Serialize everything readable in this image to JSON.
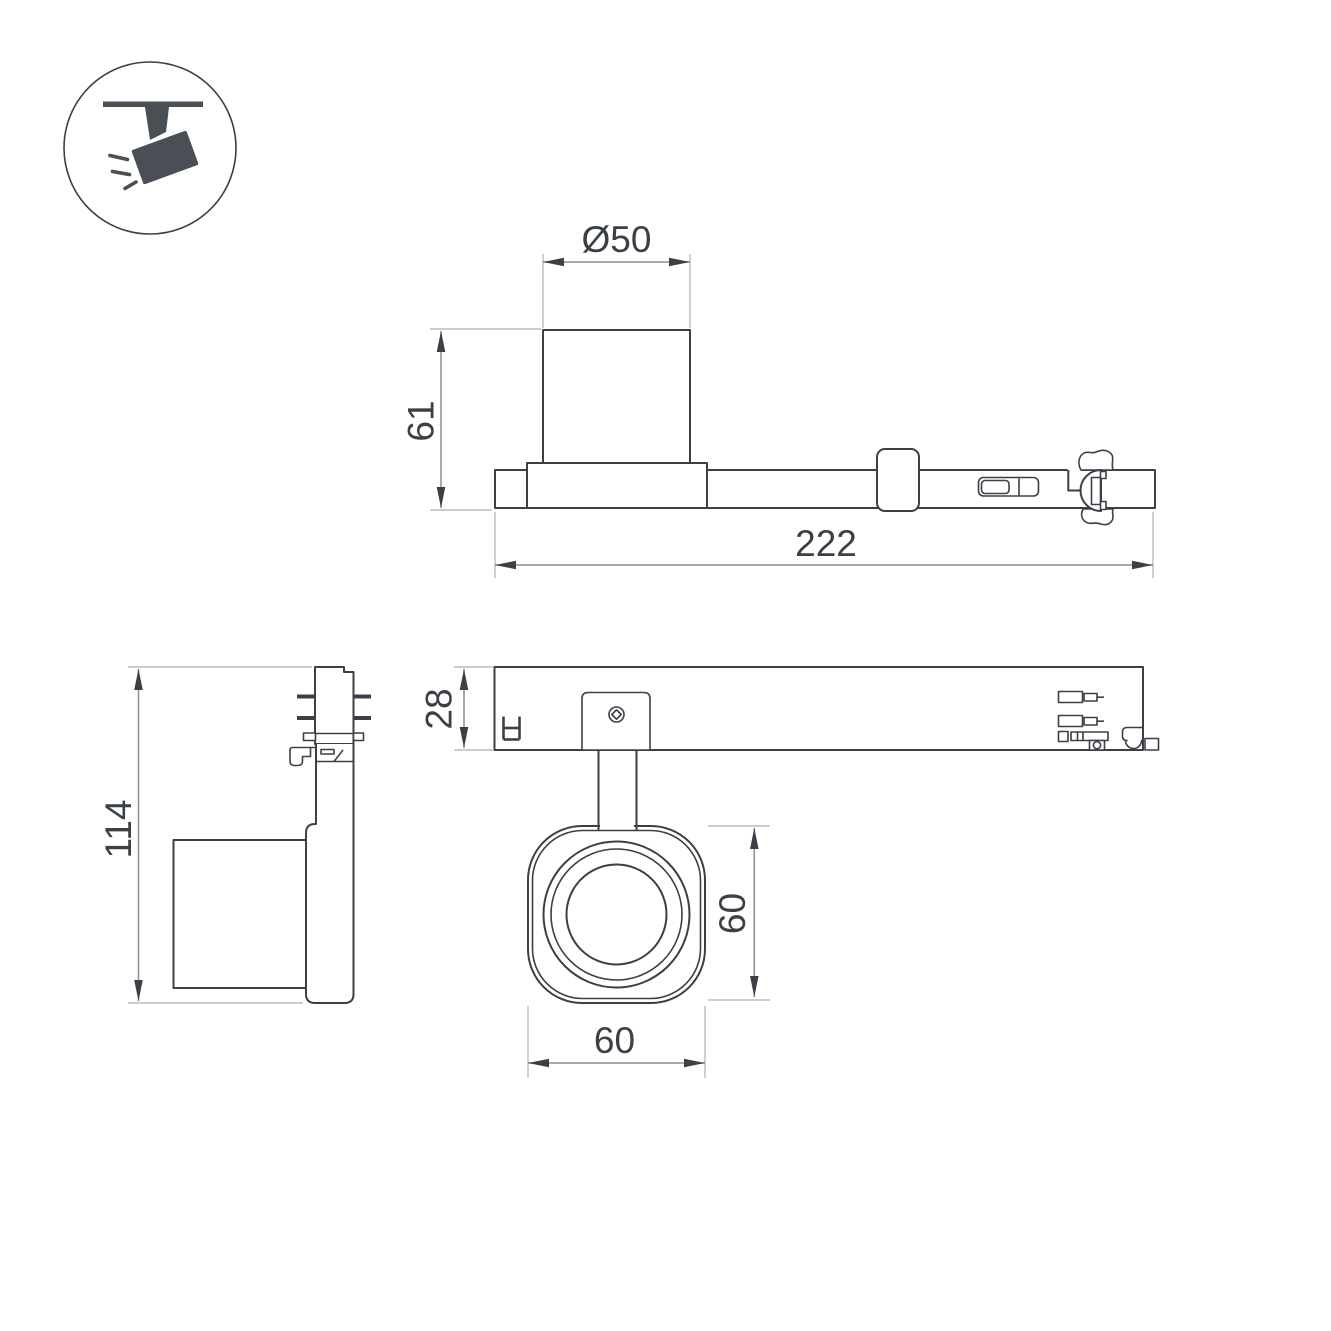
{
  "drawing": {
    "kind": "technical dimension drawing",
    "subject": "track-mounted spotlight luminaire"
  },
  "legend_icon": {
    "name": "track-spotlight-icon"
  },
  "colors": {
    "outline": "#3b4046",
    "dim_line": "#8b8e92",
    "ext_line": "#b9bbbd",
    "text": "#3b4046",
    "icon_fill": "#4a4f55",
    "background": "#ffffff"
  },
  "views": {
    "side_elevation": {
      "dims": {
        "diameter": "Ø50",
        "height": "61",
        "length": "222"
      }
    },
    "front_elevation": {
      "dims": {
        "height": "114"
      }
    },
    "plan": {
      "dims": {
        "track_depth": "28",
        "head_height": "60",
        "head_width": "60"
      }
    }
  }
}
